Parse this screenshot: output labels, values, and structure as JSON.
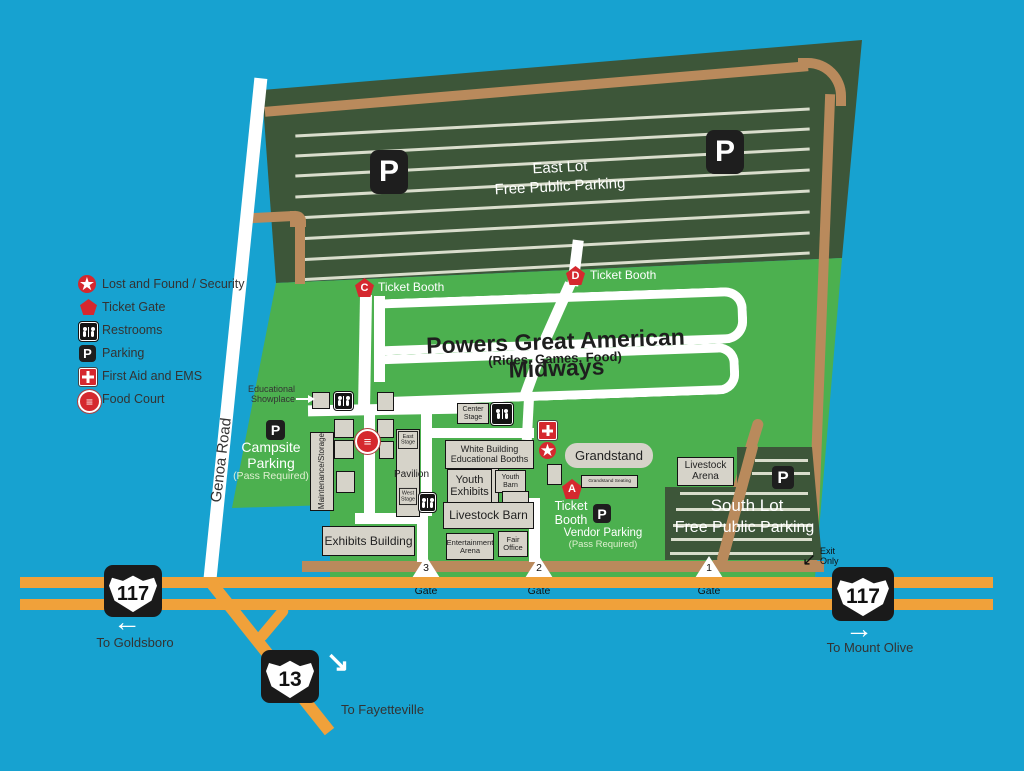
{
  "colors": {
    "background": "#17a2d0",
    "grass": "#4cb04f",
    "lot_dark": "#3d5639",
    "road_tan": "#b98a5c",
    "highway_orange": "#f0a13a",
    "marker_red": "#d5282e",
    "building_gray": "#d6d3c9"
  },
  "legend": {
    "items": [
      {
        "icon": "lost-and-found-star",
        "label": "Lost and Found / Security"
      },
      {
        "icon": "ticket-gate-pentagon",
        "label": "Ticket Gate"
      },
      {
        "icon": "restrooms",
        "label": "Restrooms"
      },
      {
        "icon": "parking",
        "label": "Parking"
      },
      {
        "icon": "first-aid",
        "label": "First Aid and EMS"
      },
      {
        "icon": "food-court",
        "label": "Food Court"
      }
    ]
  },
  "east_lot": {
    "name": "East Lot",
    "subtitle": "Free Public Parking"
  },
  "south_lot": {
    "name": "South Lot",
    "subtitle": "Free Public Parking"
  },
  "midway": {
    "title": "Powers Great American Midways",
    "subtitle": "(Rides, Games, Food)"
  },
  "booths": {
    "c": {
      "letter": "C",
      "label": "Ticket Booth"
    },
    "d": {
      "letter": "D",
      "label": "Ticket Booth"
    },
    "a": {
      "letter": "A",
      "label": "Ticket\nBooth"
    }
  },
  "buildings": {
    "educational_showplace": "Educational\nShowplace",
    "maintenance": "Maintenance/Storage",
    "east_stage": "East\nStage",
    "pavilion": "Pavilion",
    "west_stage": "West\nStage",
    "center_stage": "Center\nStage",
    "white_building": "White Building\nEducational Booths",
    "youth_exhibits": "Youth\nExhibits",
    "youth_barn": "Youth\nBarn",
    "livestock_barn": "Livestock Barn",
    "exhibits_building": "Exhibits Building",
    "entertainment_arena": "Entertainment\nArena",
    "fair_office": "Fair\nOffice",
    "grandstand": "Grandstand",
    "grandstand_seating": "Grandstand Seating",
    "livestock_arena": "Livestock\nArena"
  },
  "parking": {
    "campsite": "Campsite\nParking",
    "campsite_note": "(Pass Required)",
    "vendor": "Vendor Parking",
    "vendor_note": "(Pass Required)"
  },
  "gates": [
    {
      "number": "3",
      "label": "Gate"
    },
    {
      "number": "2",
      "label": "Gate"
    },
    {
      "number": "1",
      "label": "Gate"
    }
  ],
  "roads": {
    "genoa": "Genoa Road",
    "hwy117": "117",
    "hwy13": "13",
    "to_goldsboro": "To Goldsboro",
    "to_mount_olive": "To Mount Olive",
    "to_fayetteville": "To Fayetteville",
    "exit_only": "Exit\nOnly"
  },
  "icons": {
    "parking": "P",
    "food_glyph": "≡",
    "star_glyph": "★",
    "arrow_left": "←",
    "arrow_right": "→",
    "arrow_down_right": "↘",
    "arrow_down_left": "↙"
  }
}
